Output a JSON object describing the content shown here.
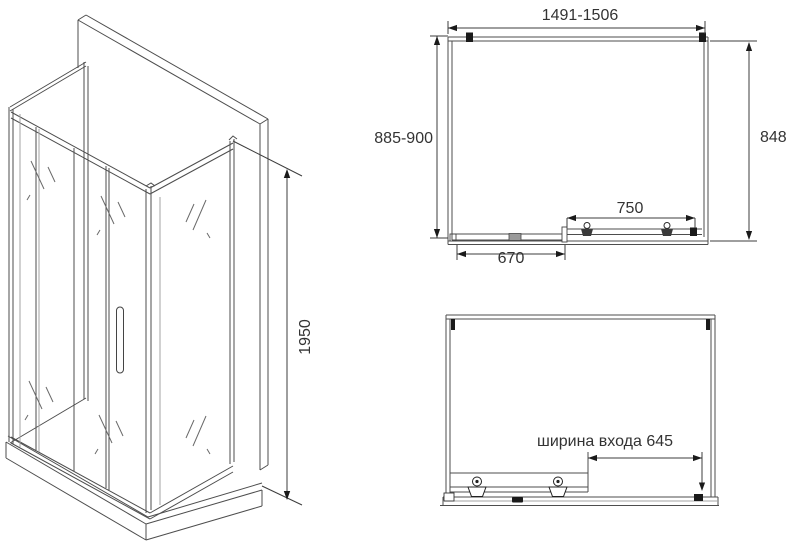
{
  "drawing": {
    "colors": {
      "line": "#4d4d4d",
      "light": "#a3a3a3",
      "accent": "#1a1a1a",
      "text": "#333333",
      "bg": "#ffffff"
    },
    "iso_view": {
      "height_dim": "1950"
    },
    "plan_view": {
      "width_dim": "1491-1506",
      "depth_dim": "885-900",
      "side_glass_dim": "848",
      "door_dim": "750",
      "fixed_panel_dim": "670"
    },
    "front_view": {
      "entrance_dim": "ширина входа 645"
    }
  }
}
